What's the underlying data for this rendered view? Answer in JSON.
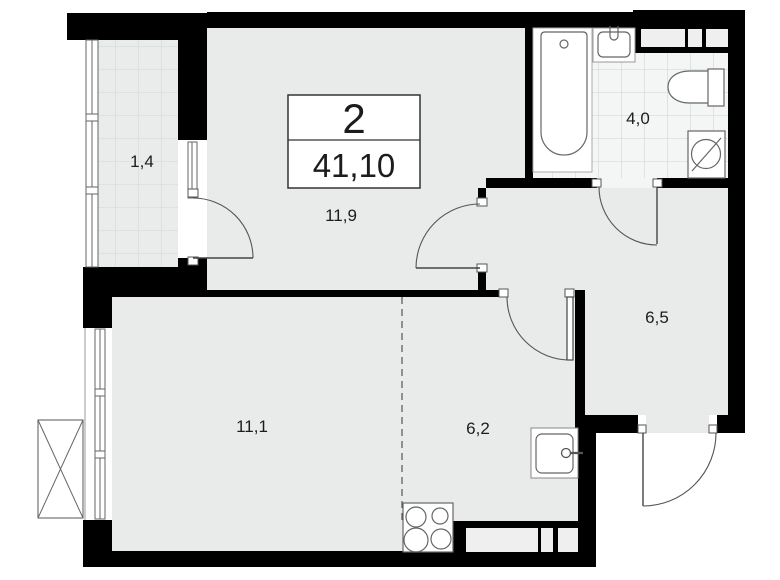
{
  "plan": {
    "room_count": "2",
    "total_area": "41,10",
    "rooms": [
      {
        "name": "balcony",
        "area": "1,4"
      },
      {
        "name": "living-room",
        "area": "11,9"
      },
      {
        "name": "bathroom",
        "area": "4,0"
      },
      {
        "name": "hallway",
        "area": "6,5"
      },
      {
        "name": "bedroom",
        "area": "11,1"
      },
      {
        "name": "kitchen",
        "area": "6,2"
      }
    ],
    "colors": {
      "walls": "#000000",
      "floor": "#e9ebeb",
      "tile_grid": "#d9dddd",
      "bathroom_floor": "#f4f6f6",
      "background": "#ffffff",
      "outline": "#555555",
      "text": "#1c1c1c"
    }
  }
}
